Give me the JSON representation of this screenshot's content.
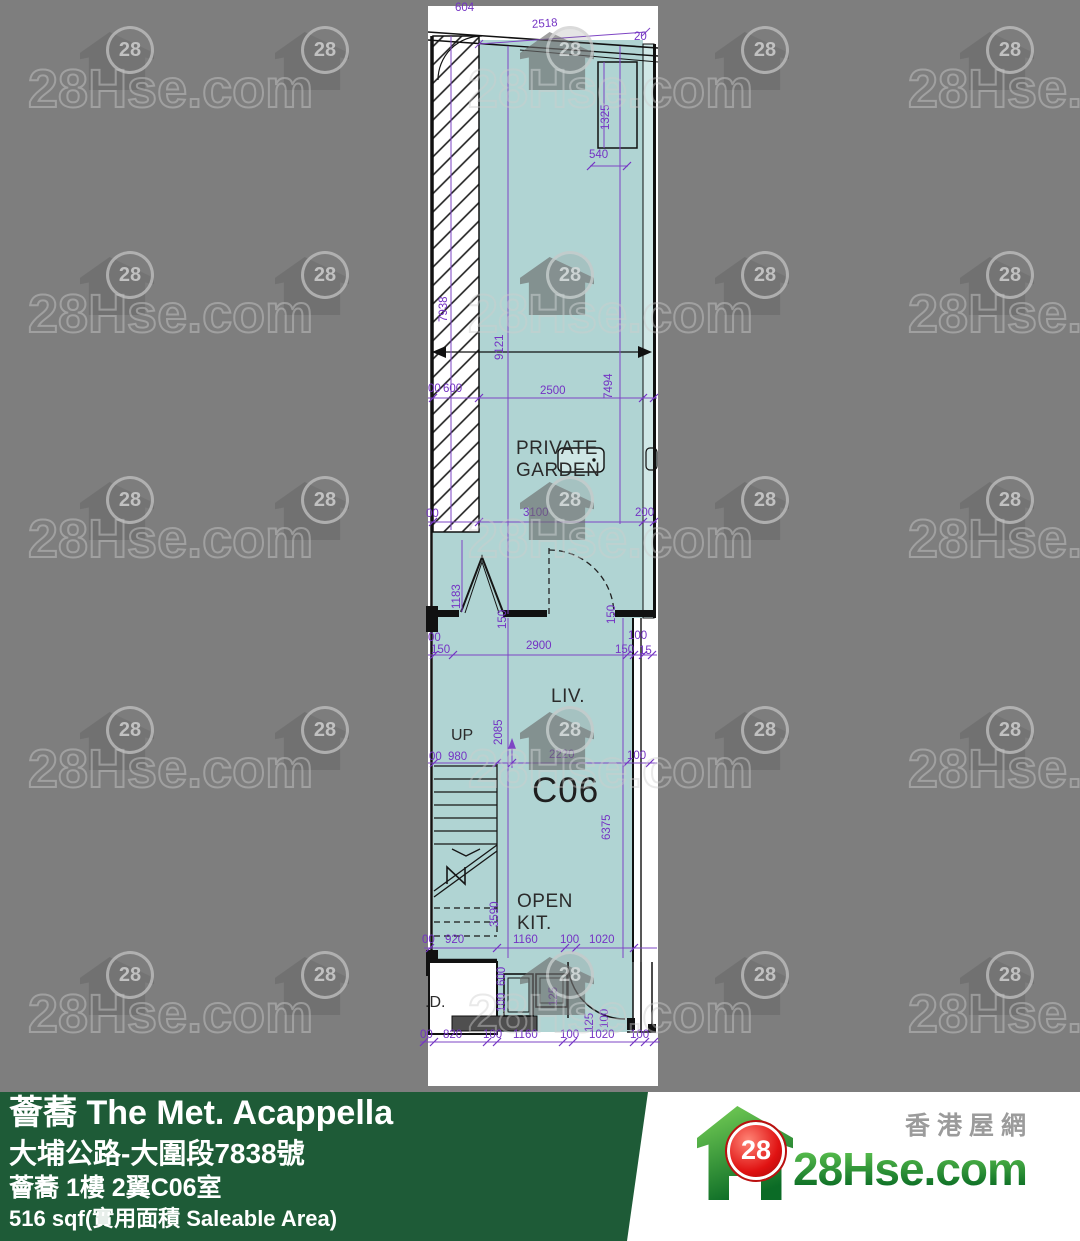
{
  "watermark": {
    "text": "28Hse.com",
    "badge": "28"
  },
  "floor_plan": {
    "unit_name": "C06",
    "labels": [
      {
        "t": "604",
        "x": 455,
        "y": 2,
        "k": "d"
      },
      {
        "t": "2518",
        "x": 532,
        "y": 18,
        "k": "d",
        "rot": -4
      },
      {
        "t": "20",
        "x": 634,
        "y": 31,
        "k": "d"
      },
      {
        "t": "1325",
        "x": 600,
        "y": 130,
        "k": "v"
      },
      {
        "t": "540",
        "x": 589,
        "y": 149,
        "k": "d"
      },
      {
        "t": "7938",
        "x": 438,
        "y": 322,
        "k": "v"
      },
      {
        "t": "9121",
        "x": 494,
        "y": 360,
        "k": "v"
      },
      {
        "t": "00",
        "x": 428,
        "y": 383,
        "k": "d"
      },
      {
        "t": "600",
        "x": 443,
        "y": 383,
        "k": "d"
      },
      {
        "t": "2500",
        "x": 540,
        "y": 385,
        "k": "d"
      },
      {
        "t": "7494",
        "x": 603,
        "y": 399,
        "k": "v"
      },
      {
        "t": "00",
        "x": 426,
        "y": 508,
        "k": "d"
      },
      {
        "t": "3100",
        "x": 523,
        "y": 507,
        "k": "d"
      },
      {
        "t": "200",
        "x": 635,
        "y": 507,
        "k": "d"
      },
      {
        "t": "1183",
        "x": 451,
        "y": 609,
        "k": "v"
      },
      {
        "t": "150",
        "x": 497,
        "y": 629,
        "k": "v"
      },
      {
        "t": "150",
        "x": 606,
        "y": 624,
        "k": "v"
      },
      {
        "t": "00",
        "x": 428,
        "y": 632,
        "k": "d"
      },
      {
        "t": "150",
        "x": 431,
        "y": 644,
        "k": "d"
      },
      {
        "t": "2900",
        "x": 526,
        "y": 640,
        "k": "d"
      },
      {
        "t": "100",
        "x": 628,
        "y": 630,
        "k": "d"
      },
      {
        "t": "150",
        "x": 615,
        "y": 644,
        "k": "d"
      },
      {
        "t": "15",
        "x": 639,
        "y": 645,
        "k": "d"
      },
      {
        "t": "PRIVATE\nGARDEN",
        "x": 516,
        "y": 438,
        "k": "r"
      },
      {
        "t": "LIV.",
        "x": 551,
        "y": 686,
        "k": "r"
      },
      {
        "t": "UP",
        "x": 451,
        "y": 727,
        "k": "s"
      },
      {
        "t": "00",
        "x": 429,
        "y": 751,
        "k": "d"
      },
      {
        "t": "980",
        "x": 448,
        "y": 751,
        "k": "d"
      },
      {
        "t": "2220",
        "x": 549,
        "y": 749,
        "k": "d"
      },
      {
        "t": "100",
        "x": 627,
        "y": 750,
        "k": "d"
      },
      {
        "t": "C06",
        "x": 532,
        "y": 770,
        "k": "b"
      },
      {
        "t": "2085",
        "x": 493,
        "y": 745,
        "k": "v"
      },
      {
        "t": "6375",
        "x": 601,
        "y": 840,
        "k": "v"
      },
      {
        "t": "3590",
        "x": 489,
        "y": 927,
        "k": "v"
      },
      {
        "t": "OPEN\nKIT.",
        "x": 517,
        "y": 891,
        "k": "r"
      },
      {
        "t": "00",
        "x": 422,
        "y": 934,
        "k": "d"
      },
      {
        "t": "920",
        "x": 445,
        "y": 934,
        "k": "d"
      },
      {
        "t": "1160",
        "x": 513,
        "y": 934,
        "k": "d"
      },
      {
        "t": "100",
        "x": 560,
        "y": 934,
        "k": "d"
      },
      {
        "t": "1020",
        "x": 589,
        "y": 934,
        "k": "d"
      },
      {
        "t": ".D.",
        "x": 425,
        "y": 994,
        "k": "s"
      },
      {
        "t": "600",
        "x": 496,
        "y": 986,
        "k": "v"
      },
      {
        "t": "100",
        "x": 496,
        "y": 1012,
        "k": "v"
      },
      {
        "t": "125",
        "x": 548,
        "y": 1006,
        "k": "v"
      },
      {
        "t": "125",
        "x": 584,
        "y": 1032,
        "k": "v"
      },
      {
        "t": "100",
        "x": 599,
        "y": 1028,
        "k": "v"
      },
      {
        "t": "00",
        "x": 420,
        "y": 1029,
        "k": "d"
      },
      {
        "t": "820",
        "x": 443,
        "y": 1029,
        "k": "d"
      },
      {
        "t": "100",
        "x": 483,
        "y": 1029,
        "k": "d"
      },
      {
        "t": "1160",
        "x": 513,
        "y": 1029,
        "k": "d"
      },
      {
        "t": "100",
        "x": 560,
        "y": 1029,
        "k": "d"
      },
      {
        "t": "1020",
        "x": 589,
        "y": 1029,
        "k": "d"
      },
      {
        "t": "100",
        "x": 630,
        "y": 1029,
        "k": "d"
      }
    ]
  },
  "footer": {
    "title": "薈蕎 The Met. Acappella",
    "address": "大埔公路-大圍段7838號",
    "unit": "薈蕎 1樓 2翼C06室",
    "area": "516 sqf(實用面積 Saleable Area)",
    "banner_color": "#1e5b37"
  },
  "logo": {
    "tagline": "香港屋網",
    "brand": "28Hse.com",
    "badge": "28",
    "brand_color": "#0a6c24",
    "badge_color": "#e01212"
  }
}
